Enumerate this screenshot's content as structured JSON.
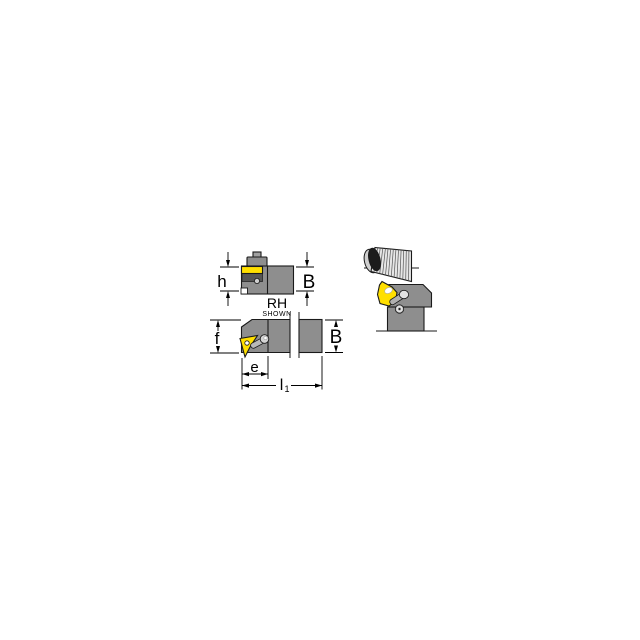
{
  "diagram": {
    "background": "#ffffff",
    "colors": {
      "holder_gray": "#8e8e8e",
      "clamp_gray": "#a0a0a0",
      "pocket_dark": "#555555",
      "insert_yellow": "#ffdf00",
      "workpiece_gray": "#e6e6e6",
      "workpiece_end_dark": "#1c1c1c",
      "outline": "#1a1a1a"
    },
    "top_view": {
      "labels": {
        "height_h": "h",
        "width_b": "B",
        "hand": "RH",
        "hand_note": "SHOWN"
      }
    },
    "side_view": {
      "labels": {
        "depth_f": "f",
        "width_b": "B",
        "offset_e": "e",
        "length_l": "l",
        "length_l_subscript": "1"
      }
    }
  }
}
